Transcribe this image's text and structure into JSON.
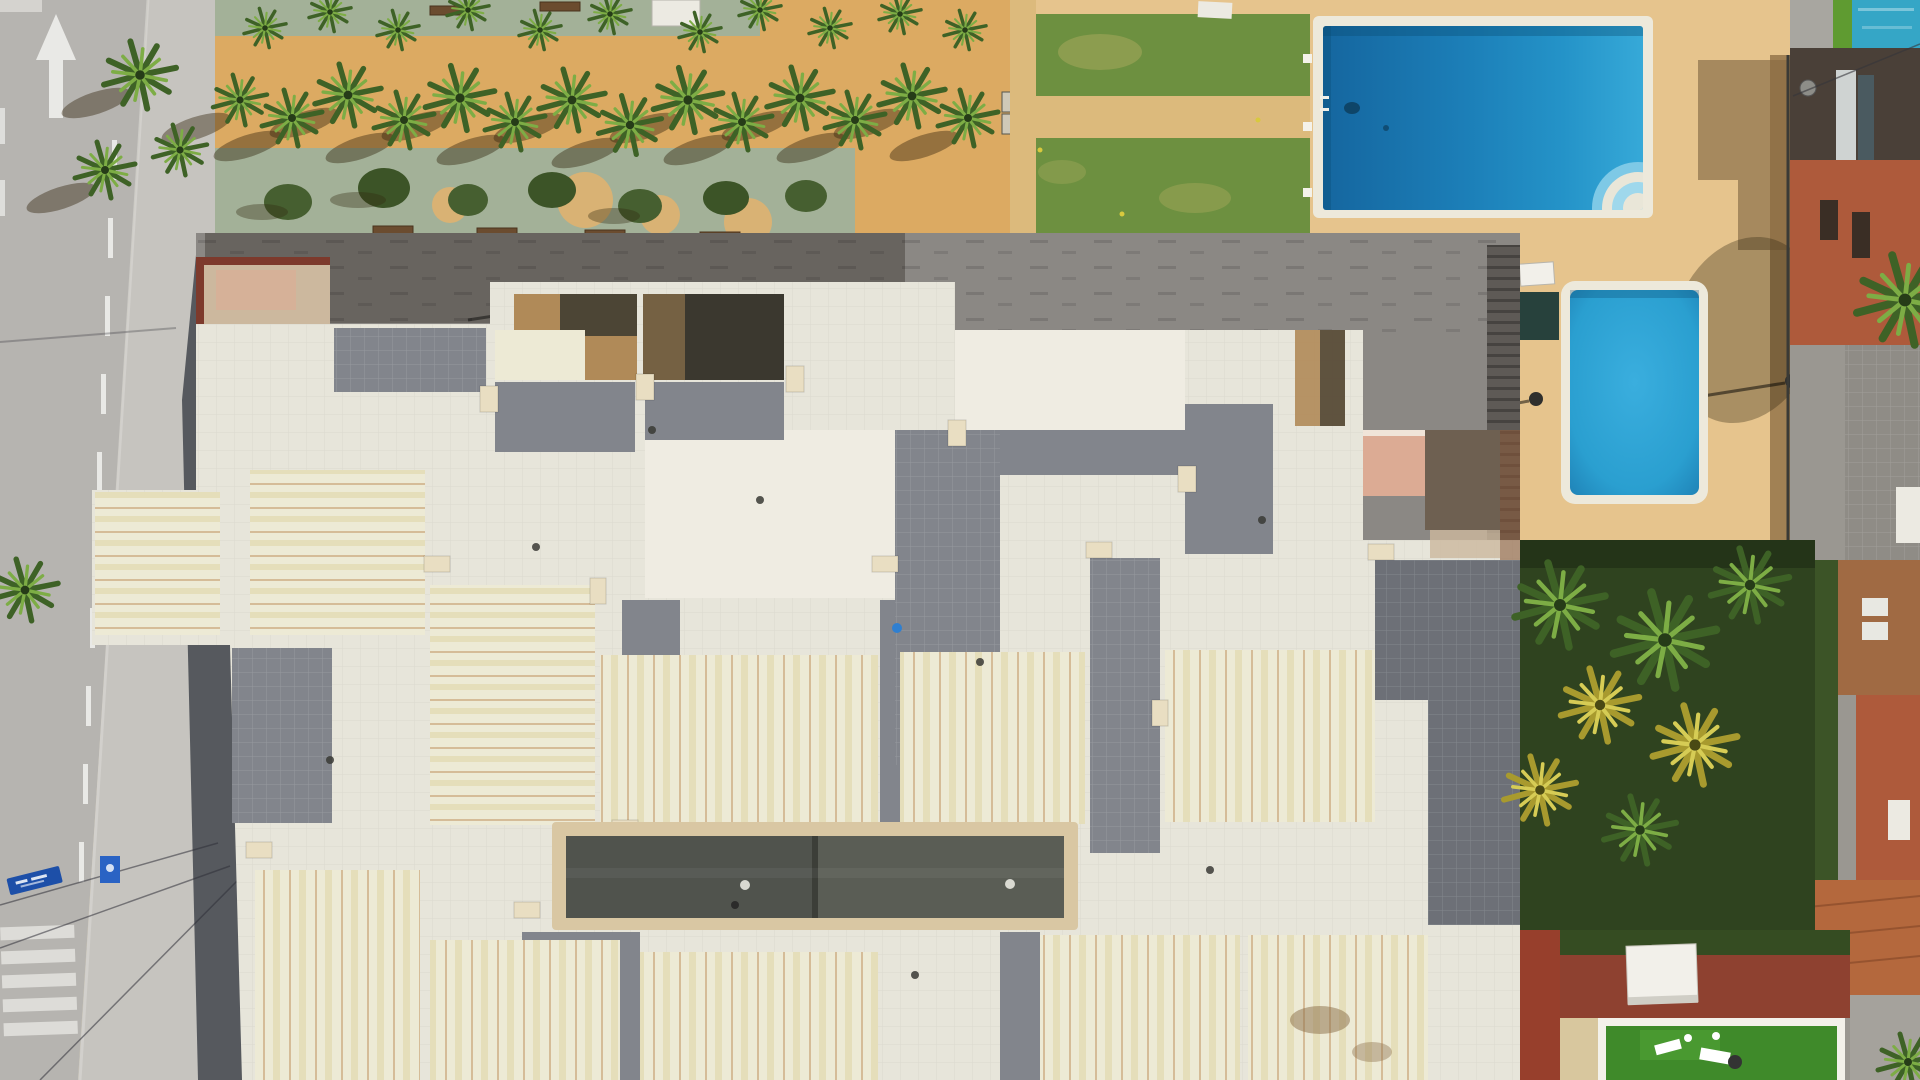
{
  "scene": {
    "description": "Aerial top-down drone photo of a Mediterranean apartment complex: a grey road with a white straight-ahead arrow, dashed lane line and zebra crosswalk on the left; a sandy palm-lined promenade with green walkway strips across the top; a lawn and two rectangular blue swimming pools on sandy sun decks at the top right; the large cream tiled rooftop terraces of the apartment block filling the centre with a long dark glass skylight; and a palm garden, artificial-turf roof terrace and terracotta-roofed neighbouring houses along the right edge.",
    "width_px": 1920,
    "height_px": 1080
  },
  "palette": {
    "road_gray": "#b6b4b0",
    "sidewalk_gray": "#c6c4bf",
    "shadow_dark": "#3d4248",
    "marking_white": "#e9e9e6",
    "crosswalk_white": "#dddcd8",
    "banner_blue": "#1d4fa8",
    "sign_blue": "#2a63c4",
    "promenade_sand": "#dcaa62",
    "strip_green": "#a3b198",
    "sand_circle": "#d9b274",
    "bench_brown": "#6b4c2f",
    "olive_dark": "#465f30",
    "lawn_green": "#6d9040",
    "lawn_worn": "#9aa355",
    "path_sand": "#dcba7c",
    "deck_sand": "#e6c48d",
    "pool_border": "#ede9db",
    "pool_deep": "#1c7fb8",
    "pool_small": "#2a9fd0",
    "asphalt": "#8b8884",
    "stair_dark": "#5e5a56",
    "roof_white": "#e7e5da",
    "roof_bright": "#efece2",
    "parapet_cream": "#e9dec2",
    "panel_pale": "#edead5",
    "tile_gray": "#82858c",
    "slate_dark": "#6d7077",
    "sky_frame": "#d9c7a3",
    "sky_glass": "#50534d",
    "sky_glass2": "#5a5d55",
    "court_tan": "#b08a58",
    "court_dark": "#3b382f",
    "pink_wall": "#dcab94",
    "maroon": "#7d3a2c",
    "tan_roof": "#ccb89e",
    "brown_roof": "#6e6051",
    "terracotta": "#b4683d",
    "orange_wall": "#ae5a3b",
    "brick_dark": "#8a3b2b",
    "turf_green": "#3f8a2a",
    "turf_frame": "#f3f1ea",
    "red_wall": "#8e4130",
    "teal_cover": "#35a6c6",
    "grass_strip": "#5f9b31",
    "canopy_white": "#f2f0ea",
    "door_white": "#eceae2",
    "metal_dark": "#3a3a36",
    "garden_dark": "#2f431f"
  },
  "road": {
    "arrow_direction": "up",
    "lane_dashes": 10,
    "crosswalk_stripes": 5,
    "banner_color": "#1d4fa8"
  },
  "pools": {
    "count": 2,
    "large": {
      "x": 1313,
      "y": 16,
      "width": 340,
      "height": 202,
      "water_color": "#1c7fb8",
      "steps": "quarter-round at bottom-right corner"
    },
    "small": {
      "x": 1561,
      "y": 281,
      "width": 147,
      "height": 223,
      "water_color": "#2a9fd0"
    }
  },
  "vegetation": {
    "promenade_palms": 25,
    "garden_palms": 7,
    "lawn_color": "#6d9040"
  },
  "buildings": {
    "roof_color": "#e7e5da",
    "skylight": {
      "x": 552,
      "y": 822,
      "width": 526,
      "height": 108,
      "glass_color": "#50534d"
    },
    "neighbor_roofs": "terracotta"
  }
}
